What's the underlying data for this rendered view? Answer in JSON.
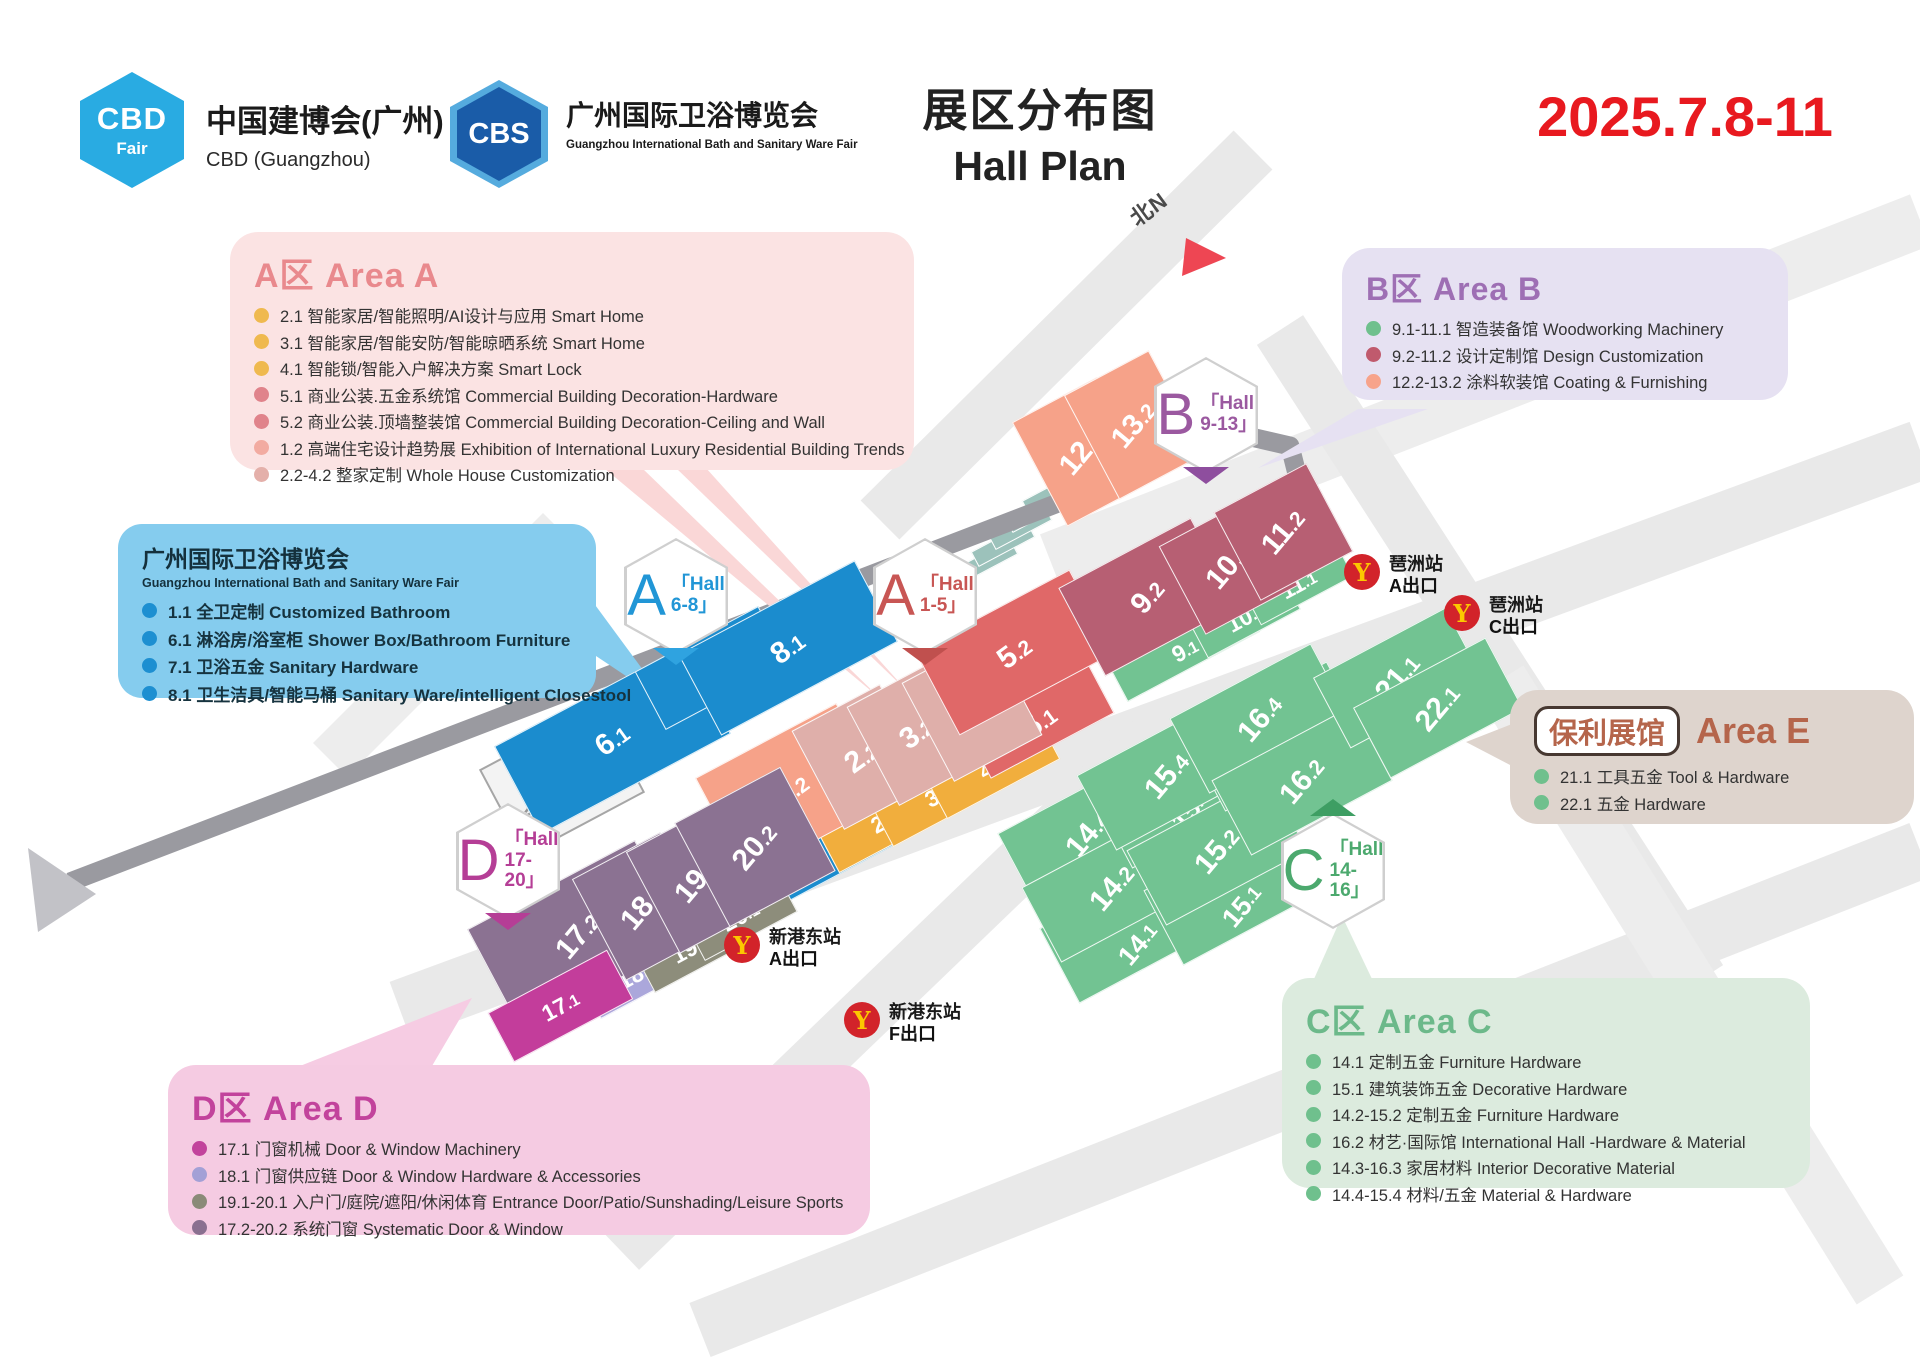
{
  "header": {
    "cbd_logo": {
      "badge_top": "CBD",
      "badge_bottom": "Fair",
      "title": "中国建博会(广州)",
      "subtitle": "CBD (Guangzhou)"
    },
    "cbs_logo": {
      "badge": "CBS",
      "title": "广州国际卫浴博览会",
      "subtitle": "Guangzhou International Bath and Sanitary Ware Fair"
    },
    "title_cn": "展区分布图",
    "title_en": "Hall Plan",
    "date": "2025.7.8-11",
    "date_color": "#E8191F"
  },
  "legends": {
    "a": {
      "title": "A区 Area A",
      "accent": "#E9898D",
      "items": [
        {
          "dot": "#EFB94F",
          "text": "2.1 智能家居/智能照明/AI设计与应用 Smart Home"
        },
        {
          "dot": "#EFB94F",
          "text": "3.1 智能家居/智能安防/智能晾晒系统 Smart Home"
        },
        {
          "dot": "#EFB94F",
          "text": "4.1 智能锁/智能入户解决方案 Smart Lock"
        },
        {
          "dot": "#E0838B",
          "text": "5.1 商业公装.五金系统馆 Commercial Building Decoration-Hardware"
        },
        {
          "dot": "#E0838B",
          "text": "5.2 商业公装.顶墙整装馆 Commercial Building Decoration-Ceiling and Wall"
        },
        {
          "dot": "#F2ABA1",
          "text": "1.2 高端住宅设计趋势展 Exhibition of International Luxury Residential Building Trends"
        },
        {
          "dot": "#E4B0AA",
          "text": "2.2-4.2 整家定制 Whole House Customization"
        }
      ]
    },
    "b": {
      "title": "B区 Area B",
      "accent": "#9E6FB4",
      "items": [
        {
          "dot": "#6FC08D",
          "text": "9.1-11.1 智造装备馆 Woodworking Machinery"
        },
        {
          "dot": "#C05A6D",
          "text": "9.2-11.2 设计定制馆 Design Customization"
        },
        {
          "dot": "#F7A38B",
          "text": "12.2-13.2 涂料软装馆 Coating & Furnishing"
        }
      ]
    },
    "bath": {
      "title": "广州国际卫浴博览会",
      "subtitle": "Guangzhou International Bath and Sanitary Ware Fair",
      "items": [
        {
          "dot": "#1D8FD1",
          "text": "1.1 全卫定制 Customized Bathroom"
        },
        {
          "dot": "#1D8FD1",
          "text": "6.1 淋浴房/浴室柜 Shower Box/Bathroom Furniture"
        },
        {
          "dot": "#1D8FD1",
          "text": "7.1 卫浴五金 Sanitary Hardware"
        },
        {
          "dot": "#1D8FD1",
          "text": "8.1 卫生洁具/智能马桶 Sanitary Ware/intelligent Closestool"
        }
      ]
    },
    "c": {
      "title": "C区 Area C",
      "accent": "#6CB98A",
      "items": [
        {
          "dot": "#6FC08D",
          "text": "14.1 定制五金 Furniture Hardware"
        },
        {
          "dot": "#6FC08D",
          "text": "15.1 建筑装饰五金 Decorative Hardware"
        },
        {
          "dot": "#6FC08D",
          "text": "14.2-15.2 定制五金 Furniture Hardware"
        },
        {
          "dot": "#6FC08D",
          "text": "16.2 材艺·国际馆 International Hall -Hardware & Material"
        },
        {
          "dot": "#6FC08D",
          "text": "14.3-16.3 家居材料 Interior Decorative Material"
        },
        {
          "dot": "#6FC08D",
          "text": "14.4-15.4 材料/五金 Material & Hardware"
        }
      ]
    },
    "d": {
      "title": "D区 Area D",
      "accent": "#C2439C",
      "items": [
        {
          "dot": "#C2439C",
          "text": "17.1 门窗机械  Door & Window Machinery"
        },
        {
          "dot": "#A3A0D6",
          "text": "18.1 门窗供应链  Door & Window Hardware & Accessories"
        },
        {
          "dot": "#8A8A78",
          "text": "19.1-20.1 入户门/庭院/遮阳/休闲体育 Entrance Door/Patio/Sunshading/Leisure Sports"
        },
        {
          "dot": "#8A7090",
          "text": "17.2-20.2 系统门窗 Systematic Door & Window"
        }
      ]
    },
    "e": {
      "pill": "保利展馆",
      "title": "Area E",
      "accent": "#B5654B",
      "items": [
        {
          "dot": "#6FC08D",
          "text": "21.1 工具五金 Tool & Hardware"
        },
        {
          "dot": "#6FC08D",
          "text": "22.1 五金 Hardware"
        }
      ]
    }
  },
  "map": {
    "north": "北N",
    "conference": {
      "line1": "国际",
      "line2": "会议中心"
    },
    "metro": {
      "circle": "#D2232A",
      "glyph": "#FCC800"
    },
    "stations": [
      {
        "name": "琶洲站",
        "exit": "A出口"
      },
      {
        "name": "琶洲站",
        "exit": "C出口"
      },
      {
        "name": "新港东站",
        "exit": "A出口"
      },
      {
        "name": "新港东站",
        "exit": "F出口"
      }
    ],
    "badges": [
      {
        "letter": "A",
        "line1": "「Hall",
        "line2": "6-8」",
        "color": "#2196D6",
        "tab": "#2FA3E0"
      },
      {
        "letter": "A",
        "line1": "「Hall",
        "line2": "1-5」",
        "color": "#C85654",
        "tab": "#C0504E"
      },
      {
        "letter": "B",
        "line1": "「Hall",
        "line2": "9-13」",
        "color": "#9B59A0",
        "tab": "#8E4E9E"
      },
      {
        "letter": "C",
        "line1": "「Hall",
        "line2": "14-16」",
        "color": "#4CA96E",
        "tab": "#3E9E63"
      },
      {
        "letter": "D",
        "line1": "「Hall",
        "line2": "17-20」",
        "color": "#B53E96",
        "tab": "#B53E96"
      }
    ],
    "colors": {
      "blue": "#1B8CCE",
      "salmon": "#F6A289",
      "rose": "#DFAFAA",
      "red": "#E06868",
      "yellow": "#F1AE3D",
      "darkred": "#B75F73",
      "green": "#72C392",
      "purple": "#8B7292",
      "periwinkle": "#ABA7DB",
      "olive": "#8D8D7B",
      "magenta": "#C33D9B"
    },
    "halls": [
      {
        "id": "1.1",
        "color": "blue"
      },
      {
        "id": "2.1",
        "color": "yellow"
      },
      {
        "id": "3.1",
        "color": "yellow"
      },
      {
        "id": "4.1",
        "color": "yellow"
      },
      {
        "id": "5.1",
        "color": "red"
      },
      {
        "id": "1.2",
        "color": "salmon"
      },
      {
        "id": "2.2",
        "color": "rose"
      },
      {
        "id": "3.2",
        "color": "rose"
      },
      {
        "id": "4.2",
        "color": "rose"
      },
      {
        "id": "5.2",
        "color": "red"
      },
      {
        "id": "6.1",
        "color": "blue"
      },
      {
        "id": "7.1",
        "color": "blue"
      },
      {
        "id": "8.1",
        "color": "blue"
      },
      {
        "id": "9.1",
        "color": "green"
      },
      {
        "id": "10.1",
        "color": "green"
      },
      {
        "id": "11.1",
        "color": "green"
      },
      {
        "id": "12.2",
        "color": "salmon"
      },
      {
        "id": "13.2",
        "color": "salmon"
      },
      {
        "id": "9.2",
        "color": "darkred"
      },
      {
        "id": "10.2",
        "color": "darkred"
      },
      {
        "id": "11.2",
        "color": "darkred"
      },
      {
        "id": "14.3",
        "color": "green"
      },
      {
        "id": "14.4",
        "color": "green"
      },
      {
        "id": "14.1",
        "color": "green"
      },
      {
        "id": "14.2",
        "color": "green"
      },
      {
        "id": "15.3",
        "color": "green"
      },
      {
        "id": "15.4",
        "color": "green"
      },
      {
        "id": "15.1",
        "color": "green"
      },
      {
        "id": "15.2",
        "color": "green"
      },
      {
        "id": "16.3",
        "color": "green"
      },
      {
        "id": "16.4",
        "color": "green"
      },
      {
        "id": "16.2",
        "color": "green"
      },
      {
        "id": "21.1",
        "color": "green"
      },
      {
        "id": "22.1",
        "color": "green"
      },
      {
        "id": "18.1",
        "color": "periwinkle"
      },
      {
        "id": "19.1",
        "color": "olive"
      },
      {
        "id": "20.1",
        "color": "olive"
      },
      {
        "id": "17.2",
        "color": "purple"
      },
      {
        "id": "18.2",
        "color": "purple"
      },
      {
        "id": "19.2",
        "color": "purple"
      },
      {
        "id": "20.2",
        "color": "purple"
      },
      {
        "id": "17.1",
        "color": "magenta"
      }
    ]
  }
}
